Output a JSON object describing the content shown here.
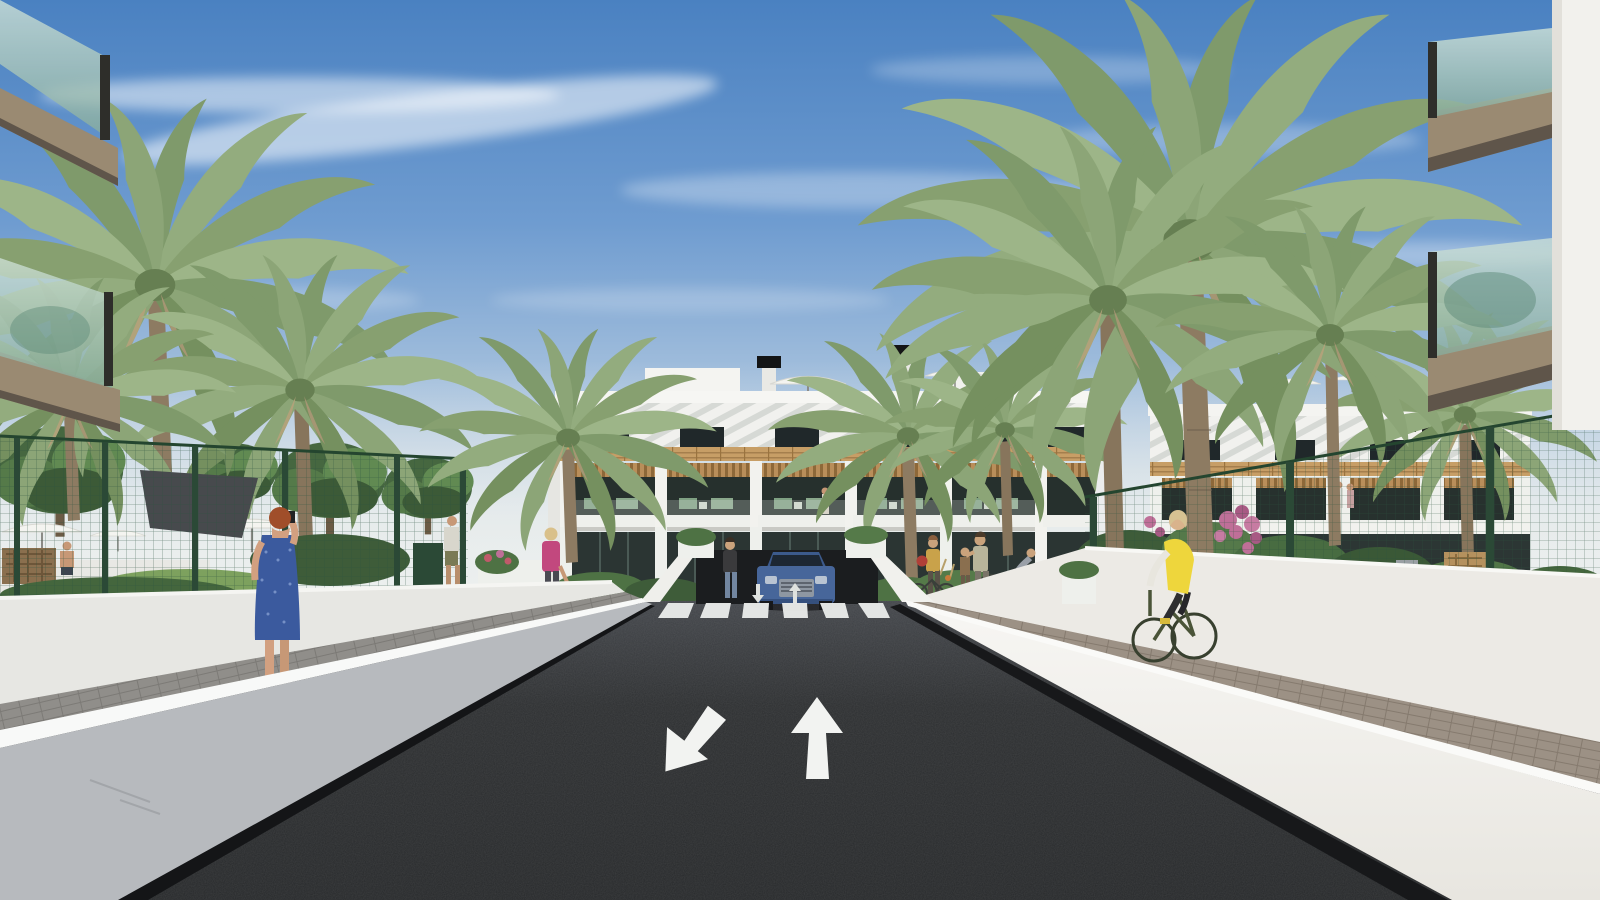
{
  "scene": {
    "type": "architectural-exterior-render",
    "setting": "new-build apartment complex street view with entrance road, crosswalk, palm trees, gardens and pedestrians",
    "time_of_day": "daytime-sunny"
  },
  "palette": {
    "sky_top": "#4a81c1",
    "sky_mid": "#7aa4d3",
    "sky_horizon": "#e9ebe9",
    "cloud_white": "#ffffff",
    "asphalt_near": "#26282a",
    "asphalt_far": "#42454a",
    "road_marking": "#eceeec",
    "wall_shaded": "#b7babe",
    "wall_sunlit": "#f3f3ef",
    "wall_cap": "#fafbfa",
    "building_white": "#f2f2ee",
    "wood_accent": "#c79e66",
    "glass_dark": "#26302d",
    "glass_balcony_teal": "#9ec3b4",
    "balcony_fascia_tan": "#9a8a72",
    "fence_green": "#2d5340",
    "foliage_dark": "#3e5c39",
    "foliage_light": "#6d9158",
    "palm_green": "#87a070",
    "palm_trunk": "#8d7b62",
    "paver_gray": "#908e8a",
    "paver_brown": "#9c9185",
    "car_blue": "#47669a",
    "vest_yellow": "#eed63c",
    "dress_blue": "#3b5a9e",
    "flower_pink": "#bf6f98",
    "shade_sail_gray": "#474a4d"
  },
  "road": {
    "crosswalk_stripe_count": 6,
    "lane_arrows": [
      "down-left",
      "up"
    ],
    "small_markings": [
      "down-arrow",
      "up-arrow"
    ]
  },
  "vehicles": [
    {
      "label": "blue-suv",
      "color": "#47669a",
      "position": "garage-entrance"
    }
  ],
  "people": [
    {
      "label": "woman-on-phone",
      "clothing": "blue patterned dress",
      "hair": "auburn",
      "location": "left sidewalk"
    },
    {
      "label": "man-walking",
      "clothing": "white tee, olive shorts",
      "location": "left path"
    },
    {
      "label": "woman-with-handbag",
      "clothing": "pink top, dark trousers",
      "hair": "blonde",
      "location": "left courtyard"
    },
    {
      "label": "woman-standing",
      "clothing": "dark top, jeans",
      "location": "beside car"
    },
    {
      "label": "woman-with-bicycle",
      "clothing": "mustard top, red bag",
      "location": "right courtyard"
    },
    {
      "label": "child",
      "location": "right courtyard"
    },
    {
      "label": "woman-with-child",
      "clothing": "floral top",
      "location": "right courtyard"
    },
    {
      "label": "cyclist-small",
      "location": "right courtyard"
    },
    {
      "label": "cyclist-yellow-vest",
      "clothing": "yellow vest, white sleeves, black leggings",
      "bicycle_color": "dark green",
      "location": "right sidewalk"
    },
    {
      "label": "man-at-pool",
      "clothing": "shirtless",
      "location": "left pool garden"
    }
  ],
  "buildings": {
    "center_block": {
      "floors": 3,
      "features": [
        "white diagonal roof louvers",
        "wood slat band",
        "pergola balconies",
        "dark glazing",
        "roof umbrellas",
        "chimneys"
      ]
    },
    "foreground_left": {
      "features": [
        "glass balconies",
        "tan fascias"
      ]
    },
    "foreground_right": {
      "features": [
        "white wall",
        "glass balconies",
        "tan fascias"
      ]
    }
  },
  "vegetation": {
    "palm_trees": 10,
    "leafy_trees": 4,
    "pink_bougainvillea": true,
    "garden_shrubs": true
  },
  "site": {
    "left_fence": "green mesh with gate",
    "right_fence": "green mesh",
    "pool_area": [
      "white parasols",
      "dark shade sail",
      "wicker bench"
    ],
    "bike_racks": 3
  }
}
